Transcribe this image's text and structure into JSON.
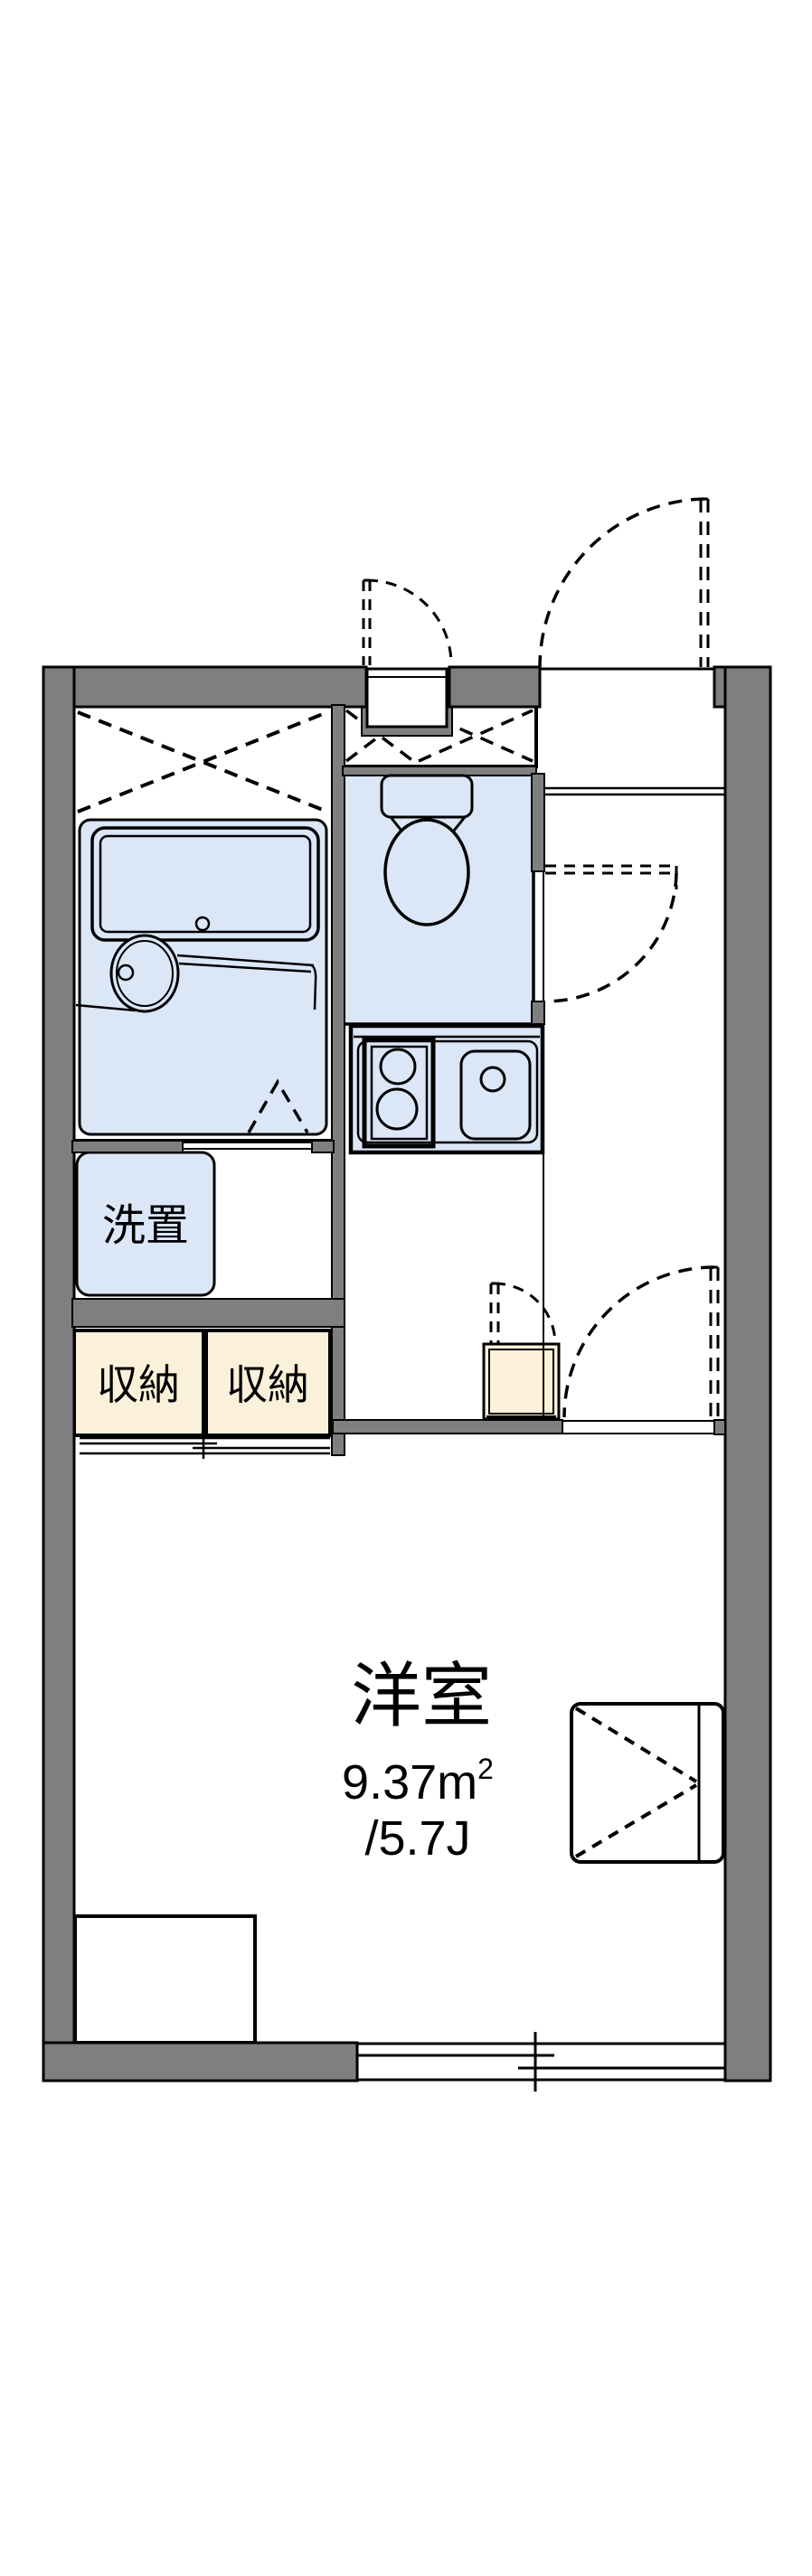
{
  "plan": {
    "type": "apartment-floor-plan",
    "rooms": {
      "living": {
        "label": "洋室",
        "area_value": "9.37",
        "area_unit_base": "m",
        "area_unit_sup": "2",
        "area_jo": "/5.7J"
      },
      "washer_space": {
        "label": "洗置"
      },
      "storage_left": {
        "label": "収納"
      },
      "storage_right": {
        "label": "収納"
      }
    },
    "colors": {
      "wall_gray": "#7f7f7f",
      "water_area_blue": "#dbe6f7",
      "storage_cream": "#fbf1da",
      "line_black": "#000000",
      "background": "#ffffff"
    }
  }
}
